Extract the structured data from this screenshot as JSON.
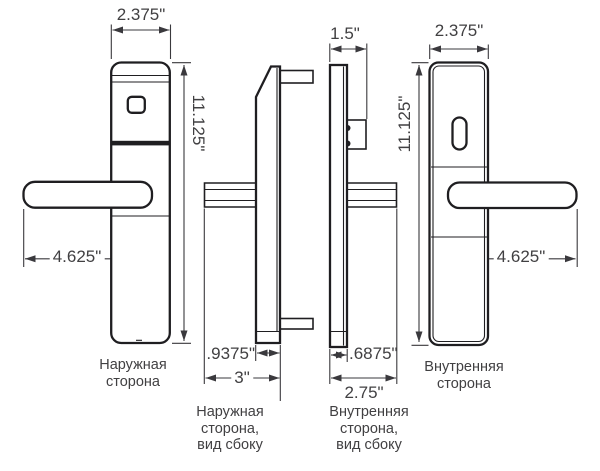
{
  "dimensions": {
    "exterior_width": "2.375\"",
    "exterior_height": "11.125\"",
    "exterior_handle_length": "4.625\"",
    "exterior_side_thickness": ".9375\"",
    "exterior_side_depth": "3\"",
    "interior_side_top_depth": "1.5\"",
    "interior_side_thickness": ".6875\"",
    "interior_side_depth": "2.75\"",
    "interior_width": "2.375\"",
    "interior_height": "11.125\"",
    "interior_handle_length": "4.625\""
  },
  "labels": {
    "exterior_front": [
      "Наружная",
      "сторона"
    ],
    "exterior_side": [
      "Наружная",
      "сторона,",
      "вид сбоку"
    ],
    "interior_side": [
      "Внутренняя",
      "сторона,",
      "вид сбоку"
    ],
    "interior_front": [
      "Внутренняя",
      "сторона"
    ]
  },
  "colors": {
    "line": "#1f1e21",
    "dim_line": "#3a393d",
    "text": "#414042",
    "background": "#ffffff"
  }
}
